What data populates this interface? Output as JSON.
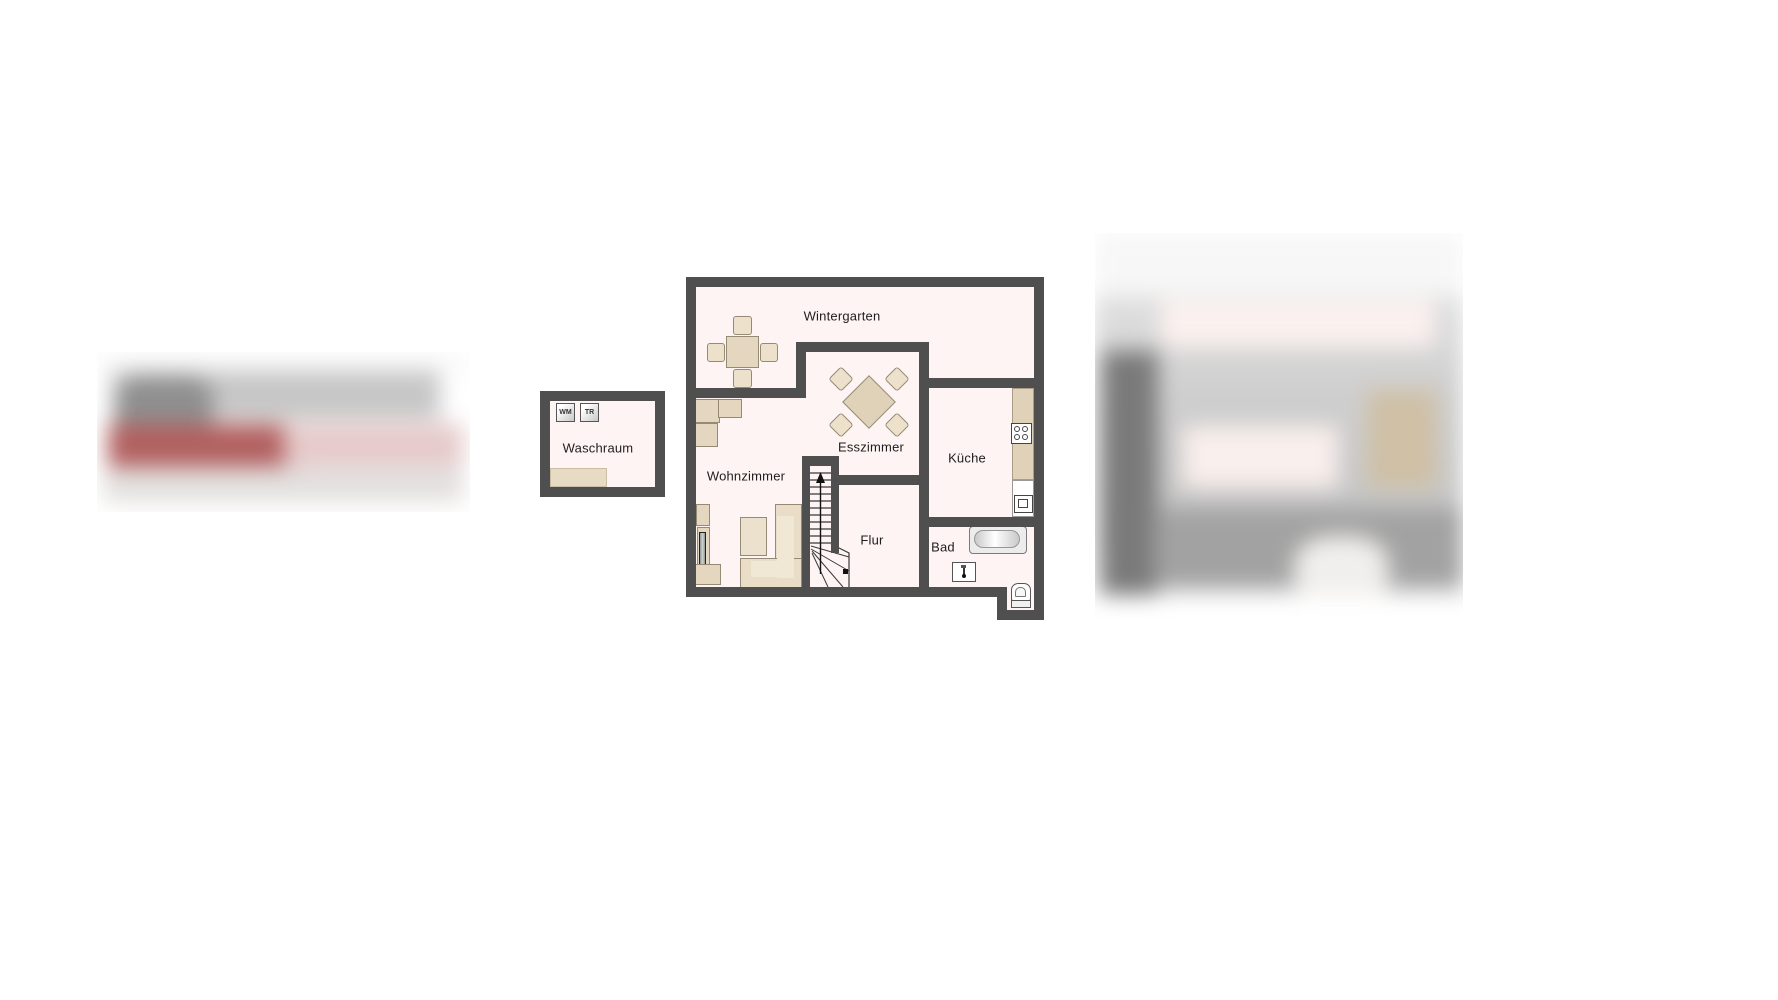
{
  "page": {
    "background": "#ffffff"
  },
  "floorplan": {
    "colors": {
      "wall": "#4f4f4f",
      "floor": "#fdf4f3",
      "furniture": "#e5d7bf",
      "furniture_border": "#958a76"
    },
    "rooms": {
      "wintergarten": {
        "label": "Wintergarten"
      },
      "waschraum": {
        "label": "Waschraum"
      },
      "wohnzimmer": {
        "label": "Wohnzimmer"
      },
      "esszimmer": {
        "label": "Esszimmer"
      },
      "kueche": {
        "label": "Küche"
      },
      "flur": {
        "label": "Flur"
      },
      "bad": {
        "label": "Bad"
      }
    },
    "appliances": {
      "washing_machine_label": "WM",
      "dryer_label": "TR"
    },
    "fixtures": [
      "stove-icon",
      "kitchen-sink",
      "bathtub",
      "bathroom-sink",
      "toilet",
      "staircase-up",
      "dining-table",
      "sofa",
      "coffee-table",
      "tv"
    ]
  }
}
